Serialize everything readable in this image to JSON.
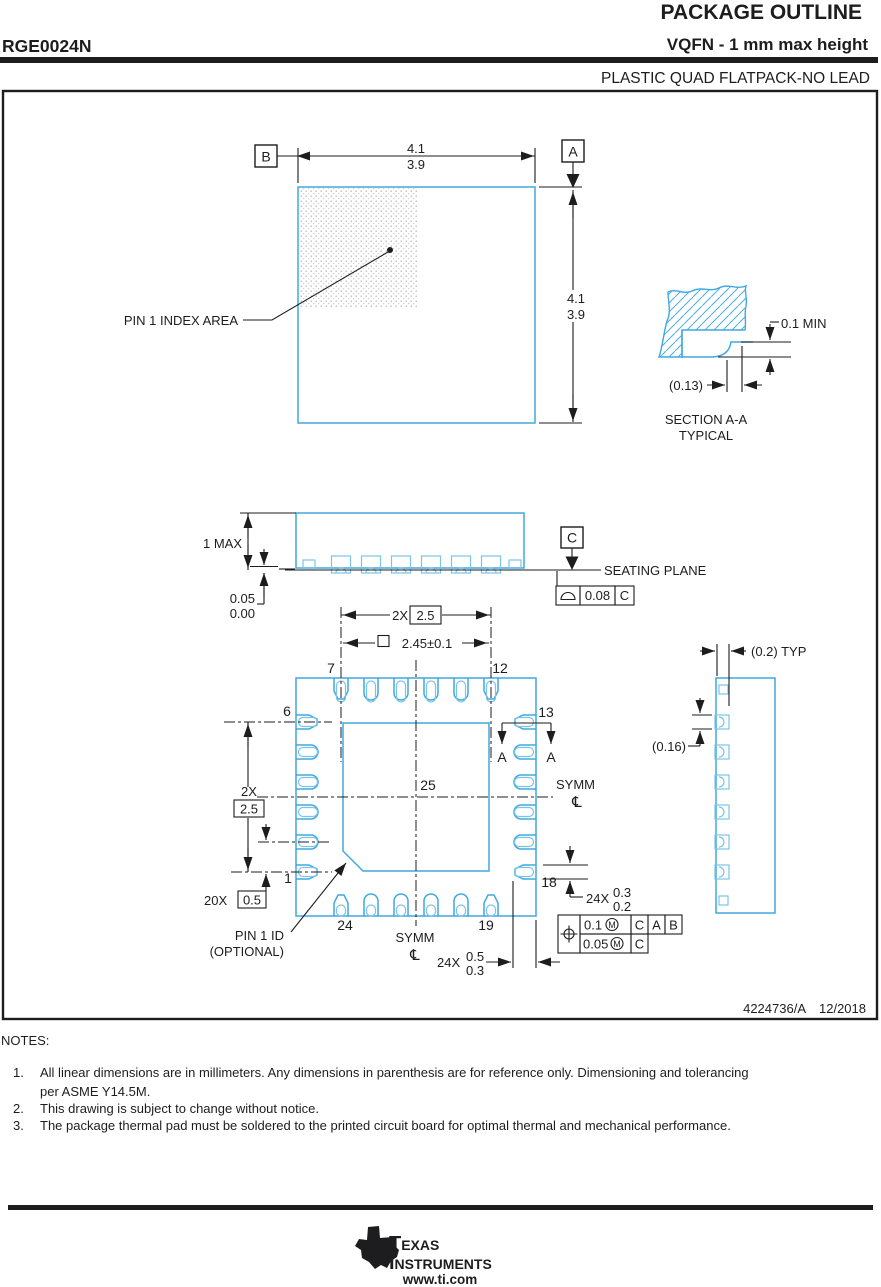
{
  "header": {
    "part_number": "RGE0024N",
    "title": "PACKAGE OUTLINE",
    "subtitle": "VQFN - 1 mm max height",
    "family": "PLASTIC QUAD FLATPACK-NO LEAD"
  },
  "colors": {
    "drawing_blue": "#3fa9e1",
    "light_blue": "#7cc4ea",
    "ink": "#1d1d1f"
  },
  "top_view": {
    "width_dim_upper": "4.1",
    "width_dim_lower": "3.9",
    "height_dim_upper": "4.1",
    "height_dim_lower": "3.9",
    "datum_a": "A",
    "datum_b": "B",
    "pin1_label": "PIN 1 INDEX AREA"
  },
  "section_view": {
    "dim_min": "0.1 MIN",
    "dim_ref": "(0.13)",
    "title": "SECTION A-A",
    "subtitle": "TYPICAL"
  },
  "side_view": {
    "dim_max": "1 MAX",
    "standoff_upper": "0.05",
    "standoff_lower": "0.00",
    "datum_c": "C",
    "seating_label": "SEATING PLANE",
    "fcf_tol": "0.08",
    "fcf_datum": "C"
  },
  "bottom_view": {
    "span_top_prefix": "2X",
    "span_top_value": "2.5",
    "pad_dim": "2.45±0.1",
    "span_left_prefix": "2X",
    "span_left_value": "2.5",
    "pitch_prefix": "20X",
    "pitch_value": "0.5",
    "pin_1": "1",
    "pin_6": "6",
    "pin_7": "7",
    "pin_12": "12",
    "pin_13": "13",
    "pin_18": "18",
    "pin_19": "19",
    "pin_24": "24",
    "pad_num": "25",
    "symm_right": "SYMM",
    "symm_bottom": "SYMM",
    "centerline_symbol": "℄",
    "section_arrow_left": "A",
    "section_arrow_right": "A",
    "lead_len_prefix": "24X",
    "lead_len_upper": "0.5",
    "lead_len_lower": "0.3",
    "lead_w_prefix": "24X",
    "lead_w_upper": "0.3",
    "lead_w_lower": "0.2",
    "pin1_id_line1": "PIN 1 ID",
    "pin1_id_line2": "(OPTIONAL)",
    "fcf1_tol": "0.1",
    "fcf1_mod": "M",
    "fcf1_d1": "C",
    "fcf1_d2": "A",
    "fcf1_d3": "B",
    "fcf2_tol": "0.05",
    "fcf2_mod": "M",
    "fcf2_d1": "C"
  },
  "detail_view": {
    "dim_typ": "(0.2) TYP",
    "dim_ref": "(0.16)"
  },
  "titleblock": {
    "doc_number": "4224736/A",
    "date": "12/2018"
  },
  "notes": {
    "label": "NOTES:",
    "items": [
      {
        "num": "1.",
        "lines": [
          "All linear dimensions are in millimeters. Any dimensions in parenthesis are for reference only. Dimensioning and tolerancing",
          "per ASME Y14.5M."
        ]
      },
      {
        "num": "2.",
        "lines": [
          "This drawing is subject to change without notice."
        ]
      },
      {
        "num": "3.",
        "lines": [
          "The package thermal pad must be soldered to the printed circuit board for optimal thermal and mechanical performance."
        ]
      }
    ]
  },
  "footer": {
    "brand_line1": "Texas",
    "brand_line2": "Instruments",
    "logo_text": "ti",
    "url": "www.ti.com"
  }
}
